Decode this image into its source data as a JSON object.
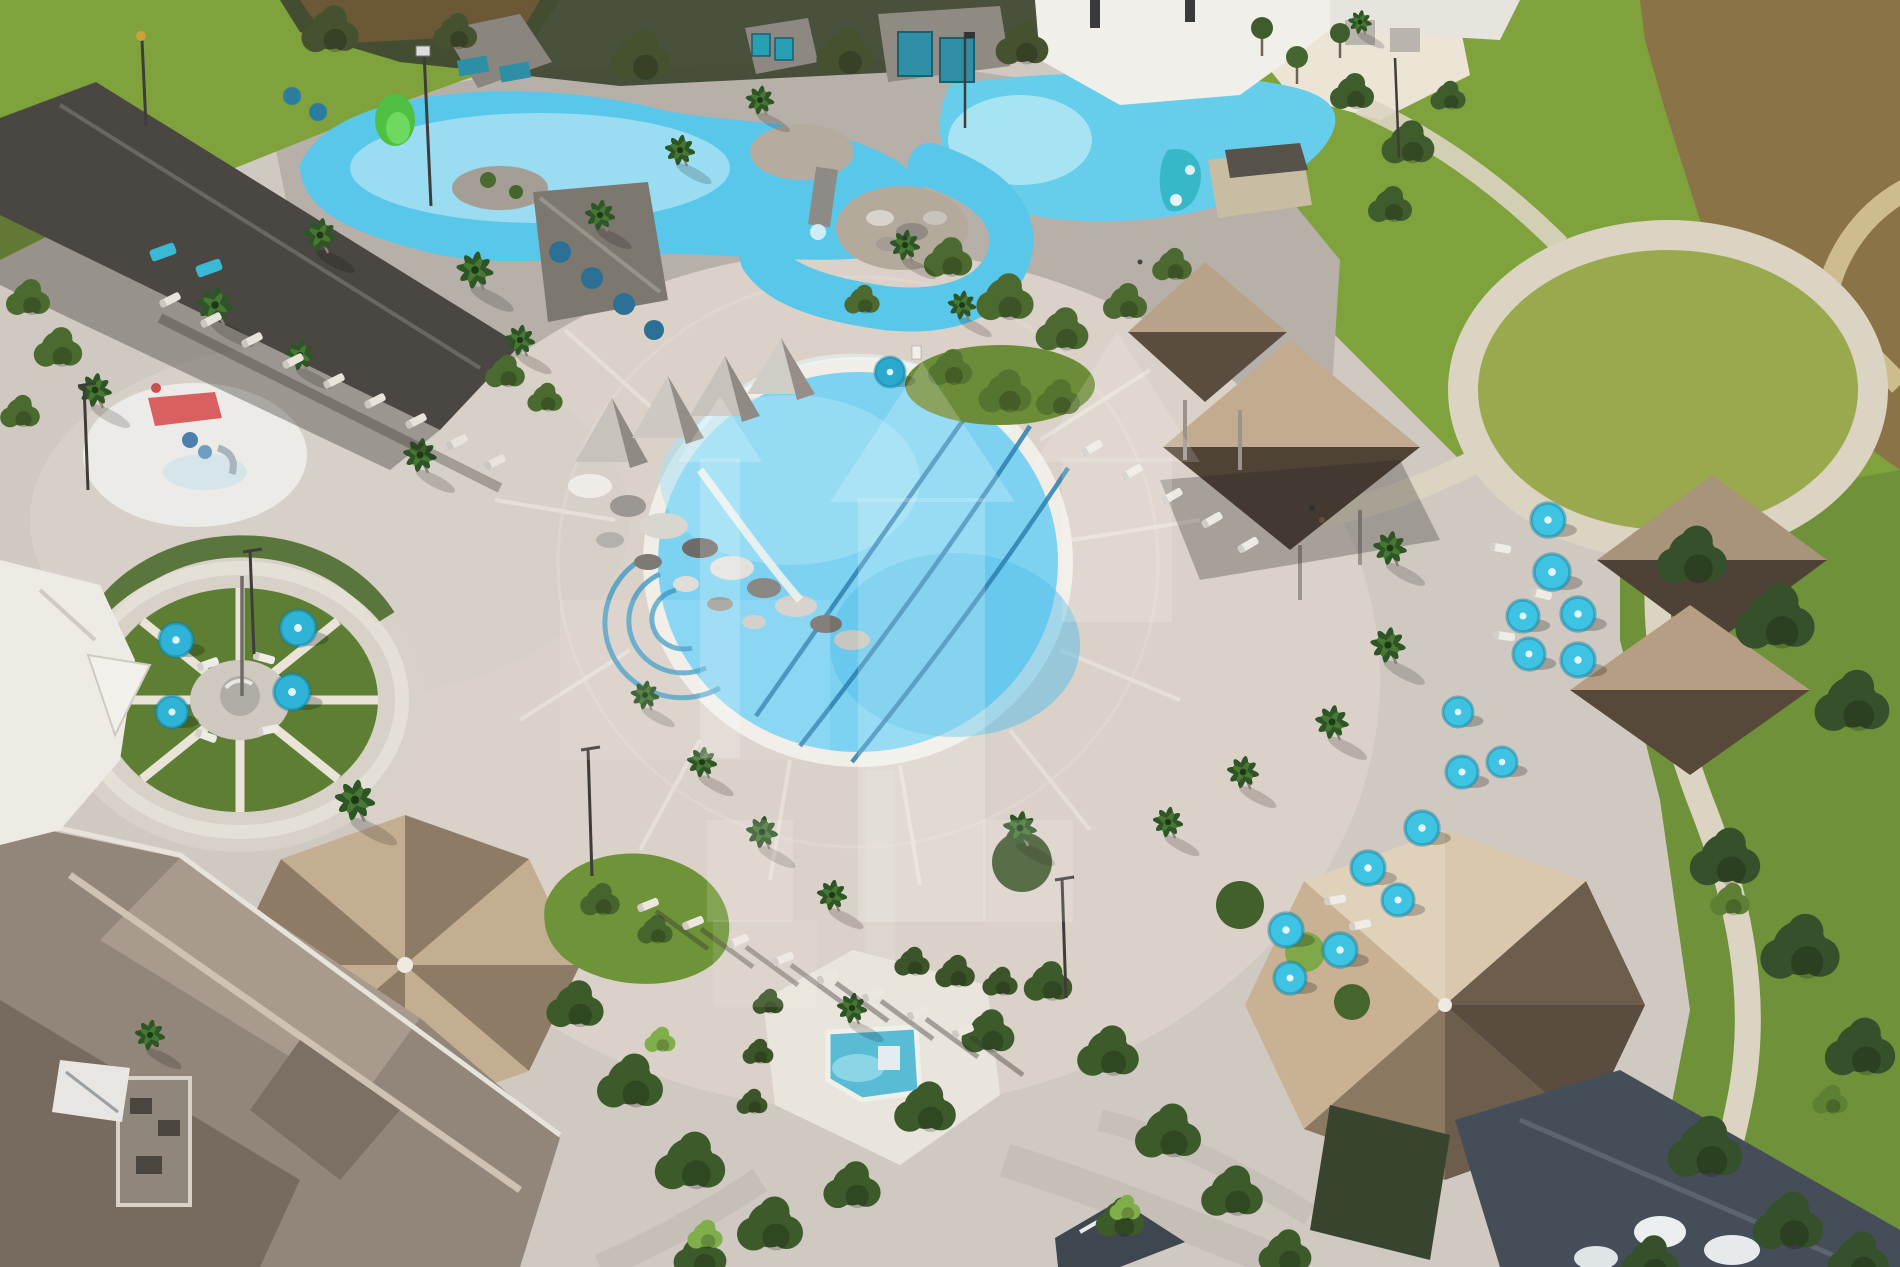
{
  "meta": {
    "type": "aerial-photograph",
    "subject": "oblique aerial photo of a resort amenity center: lazy river, round pool, spa, splash pad, umbrella garden, pavilions and lawns",
    "width_px": 1900,
    "height_px": 1267
  },
  "colors": {
    "deck_base": "#cfc9c1",
    "deck_warm": "#dad1c8",
    "deck_gray": "#b6b0a9",
    "deck_white": "#e9e5dc",
    "path_cream": "#dcd4c2",
    "path_gray": "#c5bfb8",
    "lawn": "#7fa23c",
    "lawn_yellow": "#9aa94d",
    "grass_hill": "#6f9338",
    "pond": "#8a7347",
    "sand": "#d9c99b",
    "river": "#58c7e9",
    "river_light": "#a6e0f4",
    "pool": "#7dd2f2",
    "pool_rim": "#f1eee8",
    "lane": "#2e7fae",
    "spa": "#59bcd4",
    "roof_dark": "#4a4642",
    "roof_gray": "#8a857e",
    "roof_tan": "#c4ae92",
    "roof_tan_dark": "#8d7b66",
    "roof_khaki": "#b8a288",
    "roof_brown": "#5a4c3e",
    "clubhouse": "#92857a",
    "roof_navy": "#454e58",
    "white_building": "#f1efe9",
    "umbrella_cyan": "#3fc3e3",
    "umbrella_teal": "#2fb4d8",
    "furniture_blue": "#2b6f94",
    "tree": "#3d5a2b",
    "tree_dark": "#35502a",
    "tree_light": "#557a30",
    "red_play": "#d96060",
    "rock_island": "#b3aa9b",
    "watermark": "#ffffff"
  },
  "scene": {
    "areas": [
      "lazy-river-lagoon",
      "beach-entry-pool",
      "lazy-river-loop",
      "rock-island",
      "main-round-pool",
      "spa-pool",
      "splash-pad",
      "umbrella-wheel-garden",
      "circular-event-lawn",
      "great-lawn",
      "dry-pond",
      "pool-deck",
      "clubhouse-roof",
      "hex-pavilion",
      "facet-pavilion",
      "shade-cabanas",
      "white-building",
      "palm-trees",
      "umbrella-clusters",
      "walking-paths",
      "watermark-overlay"
    ],
    "main_pool": {
      "lane_lines": 3,
      "step_arcs": 3
    },
    "wheel_garden": {
      "umbrella_count": 4,
      "spoke_count": 8
    },
    "umbrella_clusters": {
      "right_upper": 6,
      "right_mid": 3,
      "right_lower": 6
    },
    "slides": {
      "green_slide": 1,
      "teal_slide": 1
    }
  },
  "watermark": {
    "description": "translucent white arrow/bar shapes over center",
    "opacity": 0.2
  }
}
